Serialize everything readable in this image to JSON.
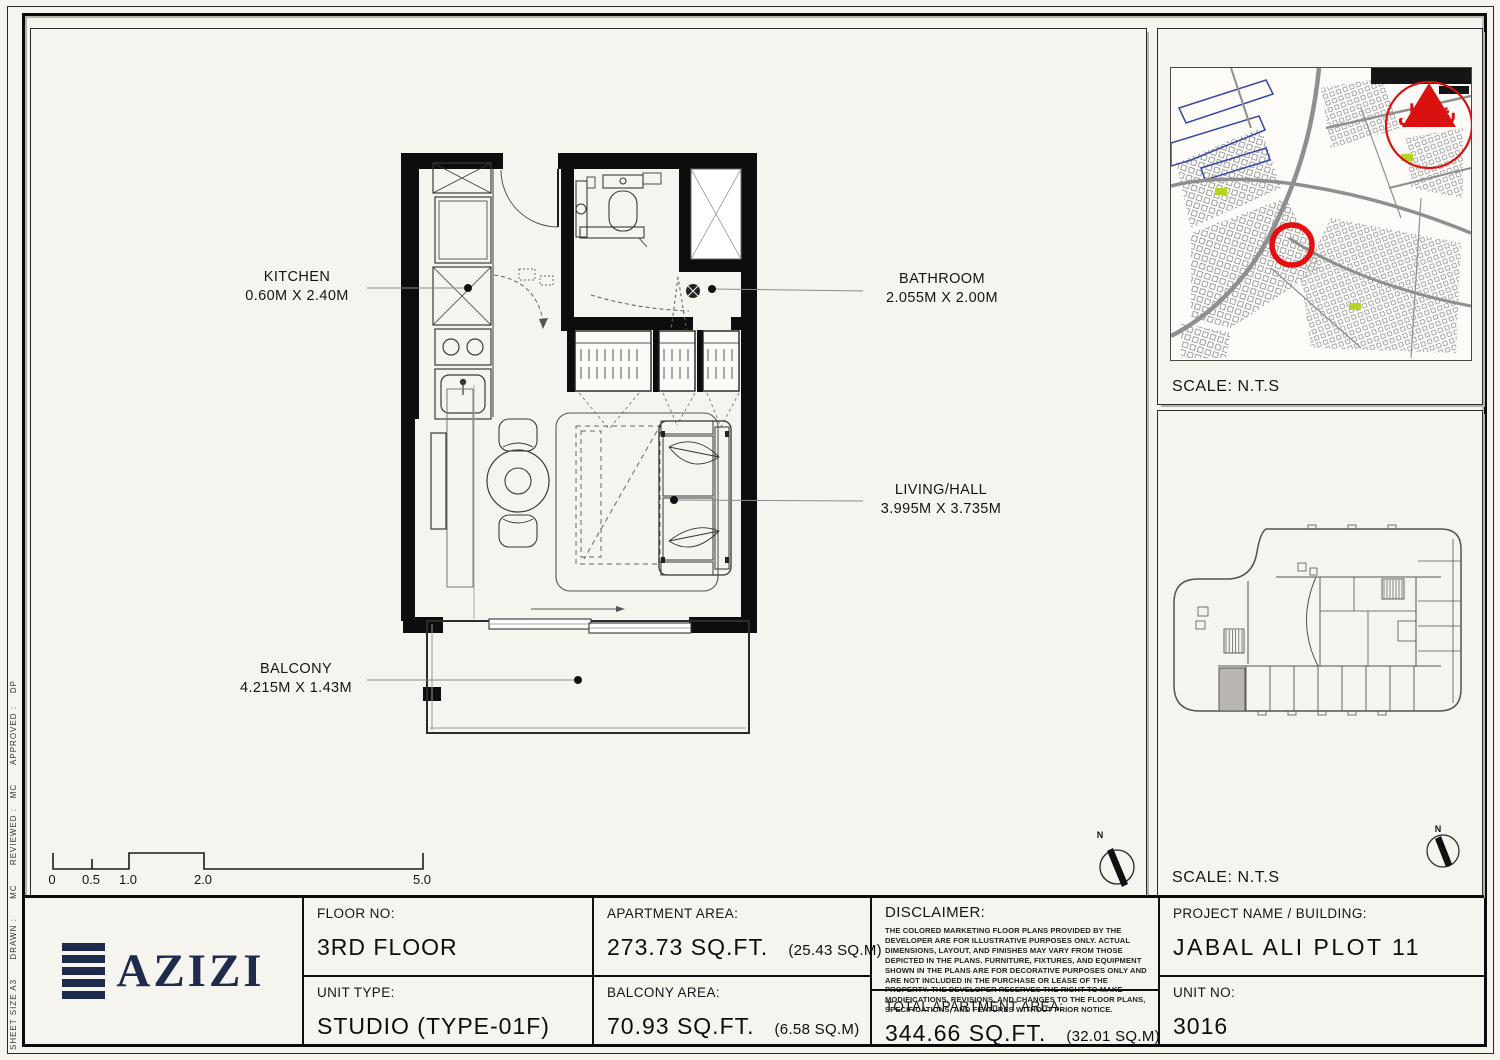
{
  "page": {
    "sidebar_text": "SHEET SIZE A3      DRAWN :      MC      REVIEWED :   MC      APPROVED :    DP"
  },
  "plan": {
    "north_label": "N",
    "scale_ticks": [
      "0",
      "0.5",
      "1.0",
      "2.0",
      "5.0"
    ],
    "rooms": [
      {
        "name": "KITCHEN",
        "dims": "0.60M X 2.40M"
      },
      {
        "name": "BATHROOM",
        "dims": "2.055M X 2.00M"
      },
      {
        "name": "LIVING/HALL",
        "dims": "3.995M X 3.735M"
      },
      {
        "name": "BALCONY",
        "dims": "4.215M X 1.43M"
      }
    ]
  },
  "panels": {
    "location_map": {
      "scale_label": "SCALE: N.T.S",
      "north_arabic": "شمال"
    },
    "key_plan": {
      "scale_label": "SCALE: N.T.S",
      "north_label": "N"
    }
  },
  "title_block": {
    "logo_text": "AZIZI",
    "floor_label": "FLOOR NO:",
    "floor_value": "3RD FLOOR",
    "unit_type_label": "UNIT TYPE:",
    "unit_type_value": "STUDIO (TYPE-01F)",
    "apartment_area_label": "APARTMENT AREA:",
    "apartment_area_value": "273.73 SQ.FT.",
    "apartment_area_metric": "(25.43 SQ.M)",
    "balcony_area_label": "BALCONY AREA:",
    "balcony_area_value": "70.93 SQ.FT.",
    "balcony_area_metric": "(6.58 SQ.M)",
    "disclaimer_label": "DISCLAIMER:",
    "disclaimer_body": "THE COLORED MARKETING FLOOR PLANS PROVIDED BY THE DEVELOPER ARE FOR ILLUSTRATIVE PURPOSES ONLY. ACTUAL DIMENSIONS, LAYOUT, AND FINISHES MAY VARY FROM THOSE DEPICTED IN THE PLANS. FURNITURE, FIXTURES, AND EQUIPMENT SHOWN IN THE PLANS ARE FOR DECORATIVE PURPOSES ONLY AND ARE NOT INCLUDED IN THE PURCHASE OR LEASE OF THE PROPERTY. THE DEVELOPER RESERVES THE RIGHT TO MAKE MODIFICATIONS, REVISIONS, AND CHANGES TO THE FLOOR PLANS, SPECIFICATIONS, AND FEATURES WITHOUT PRIOR NOTICE.",
    "total_area_label": "TOTAL APARTMENT AREA:",
    "total_area_value": "344.66 SQ.FT.",
    "total_area_metric": "(32.01 SQ.M)",
    "project_label": "PROJECT NAME / BUILDING:",
    "project_value": "JABAL ALI PLOT 11",
    "unit_no_label": "UNIT NO:",
    "unit_no_value": "3016"
  },
  "colors": {
    "paper": "#f6f4ee",
    "ink": "#111111",
    "logo_navy": "#1e2b4d",
    "north_red": "#d91111",
    "unit_highlight": "#b9b7b0"
  }
}
